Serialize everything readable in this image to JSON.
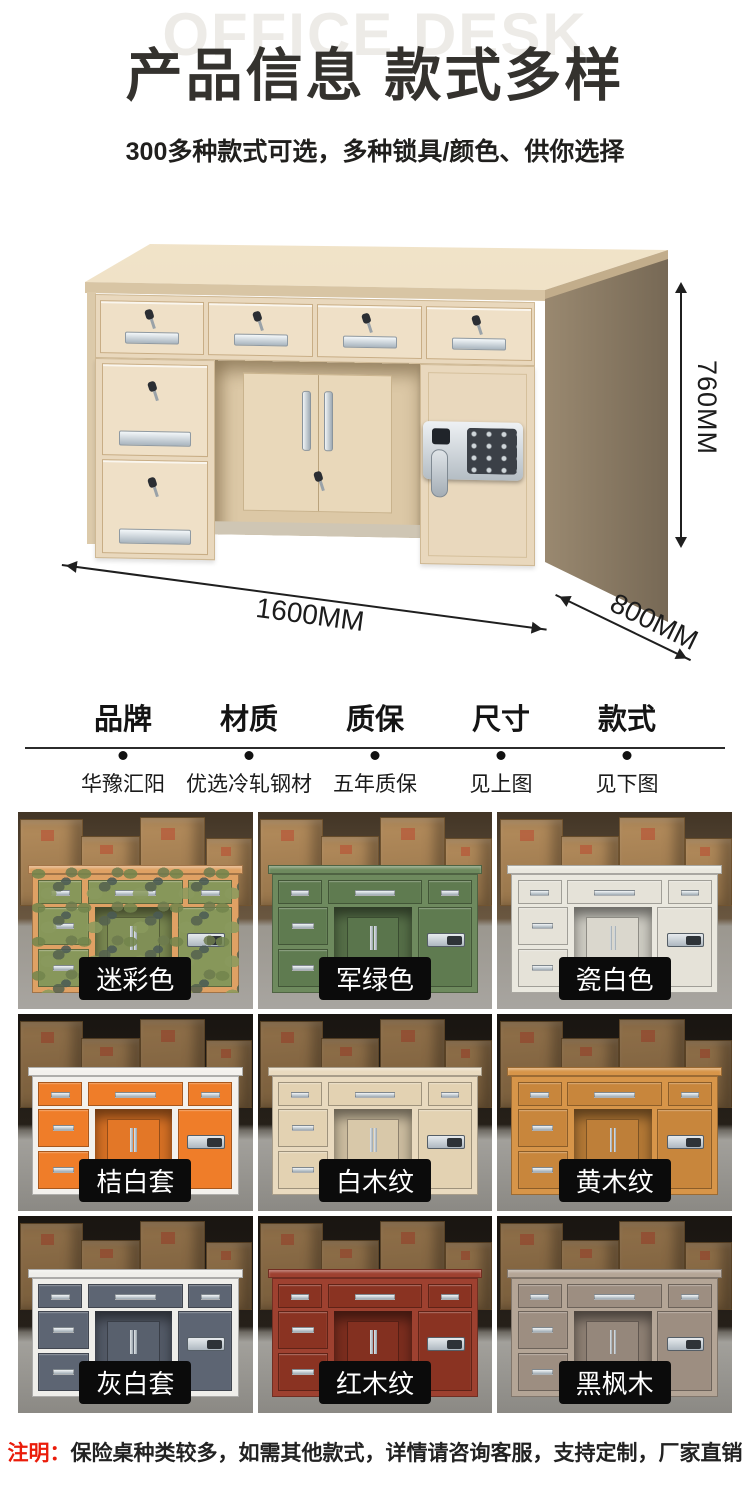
{
  "palette": {
    "title_color": "#34322e",
    "watermark_color": "#edebe7",
    "note_accent": "#ea1c0a",
    "label_chip_bg": "#0b0b0b",
    "desk_wood": "#e9d8bd"
  },
  "header": {
    "watermark": "OFFICE DESK",
    "title": "产品信息 款式多样",
    "subtitle": "300多种款式可选，多种锁具/颜色、供你选择"
  },
  "hero": {
    "dimensions": {
      "height": "760MM",
      "width": "1600MM",
      "depth": "800MM"
    }
  },
  "specs": {
    "columns": [
      {
        "label": "品牌",
        "value": "华豫汇阳"
      },
      {
        "label": "材质",
        "value": "优选冷轧钢材"
      },
      {
        "label": "质保",
        "value": "五年质保"
      },
      {
        "label": "尺寸",
        "value": "见上图"
      },
      {
        "label": "款式",
        "value": "见下图"
      }
    ]
  },
  "variants": {
    "items": [
      {
        "label": "迷彩色",
        "body": "#dfa164",
        "panel": "#87975a",
        "pattern": "camo"
      },
      {
        "label": "军绿色",
        "body": "#6e8a5e",
        "panel": "#5f7b50"
      },
      {
        "label": "瓷白色",
        "body": "#eae8df",
        "panel": "#e5e2d8"
      },
      {
        "label": "桔白套",
        "body": "#f3f1ed",
        "panel": "#ef7d29"
      },
      {
        "label": "白木纹",
        "body": "#e9dabf",
        "panel": "#e3d2b2"
      },
      {
        "label": "黄木纹",
        "body": "#d79549",
        "panel": "#c8863c"
      },
      {
        "label": "灰白套",
        "body": "#efeeea",
        "panel": "#5d6573"
      },
      {
        "label": "红木纹",
        "body": "#9e4130",
        "panel": "#8a3322"
      },
      {
        "label": "黑枫木",
        "body": "#b4a596",
        "panel": "#9d8e81"
      }
    ]
  },
  "note": {
    "prefix": "注明：",
    "text": "保险桌种类较多，如需其他款式，详情请咨询客服，支持定制，厂家直销"
  }
}
